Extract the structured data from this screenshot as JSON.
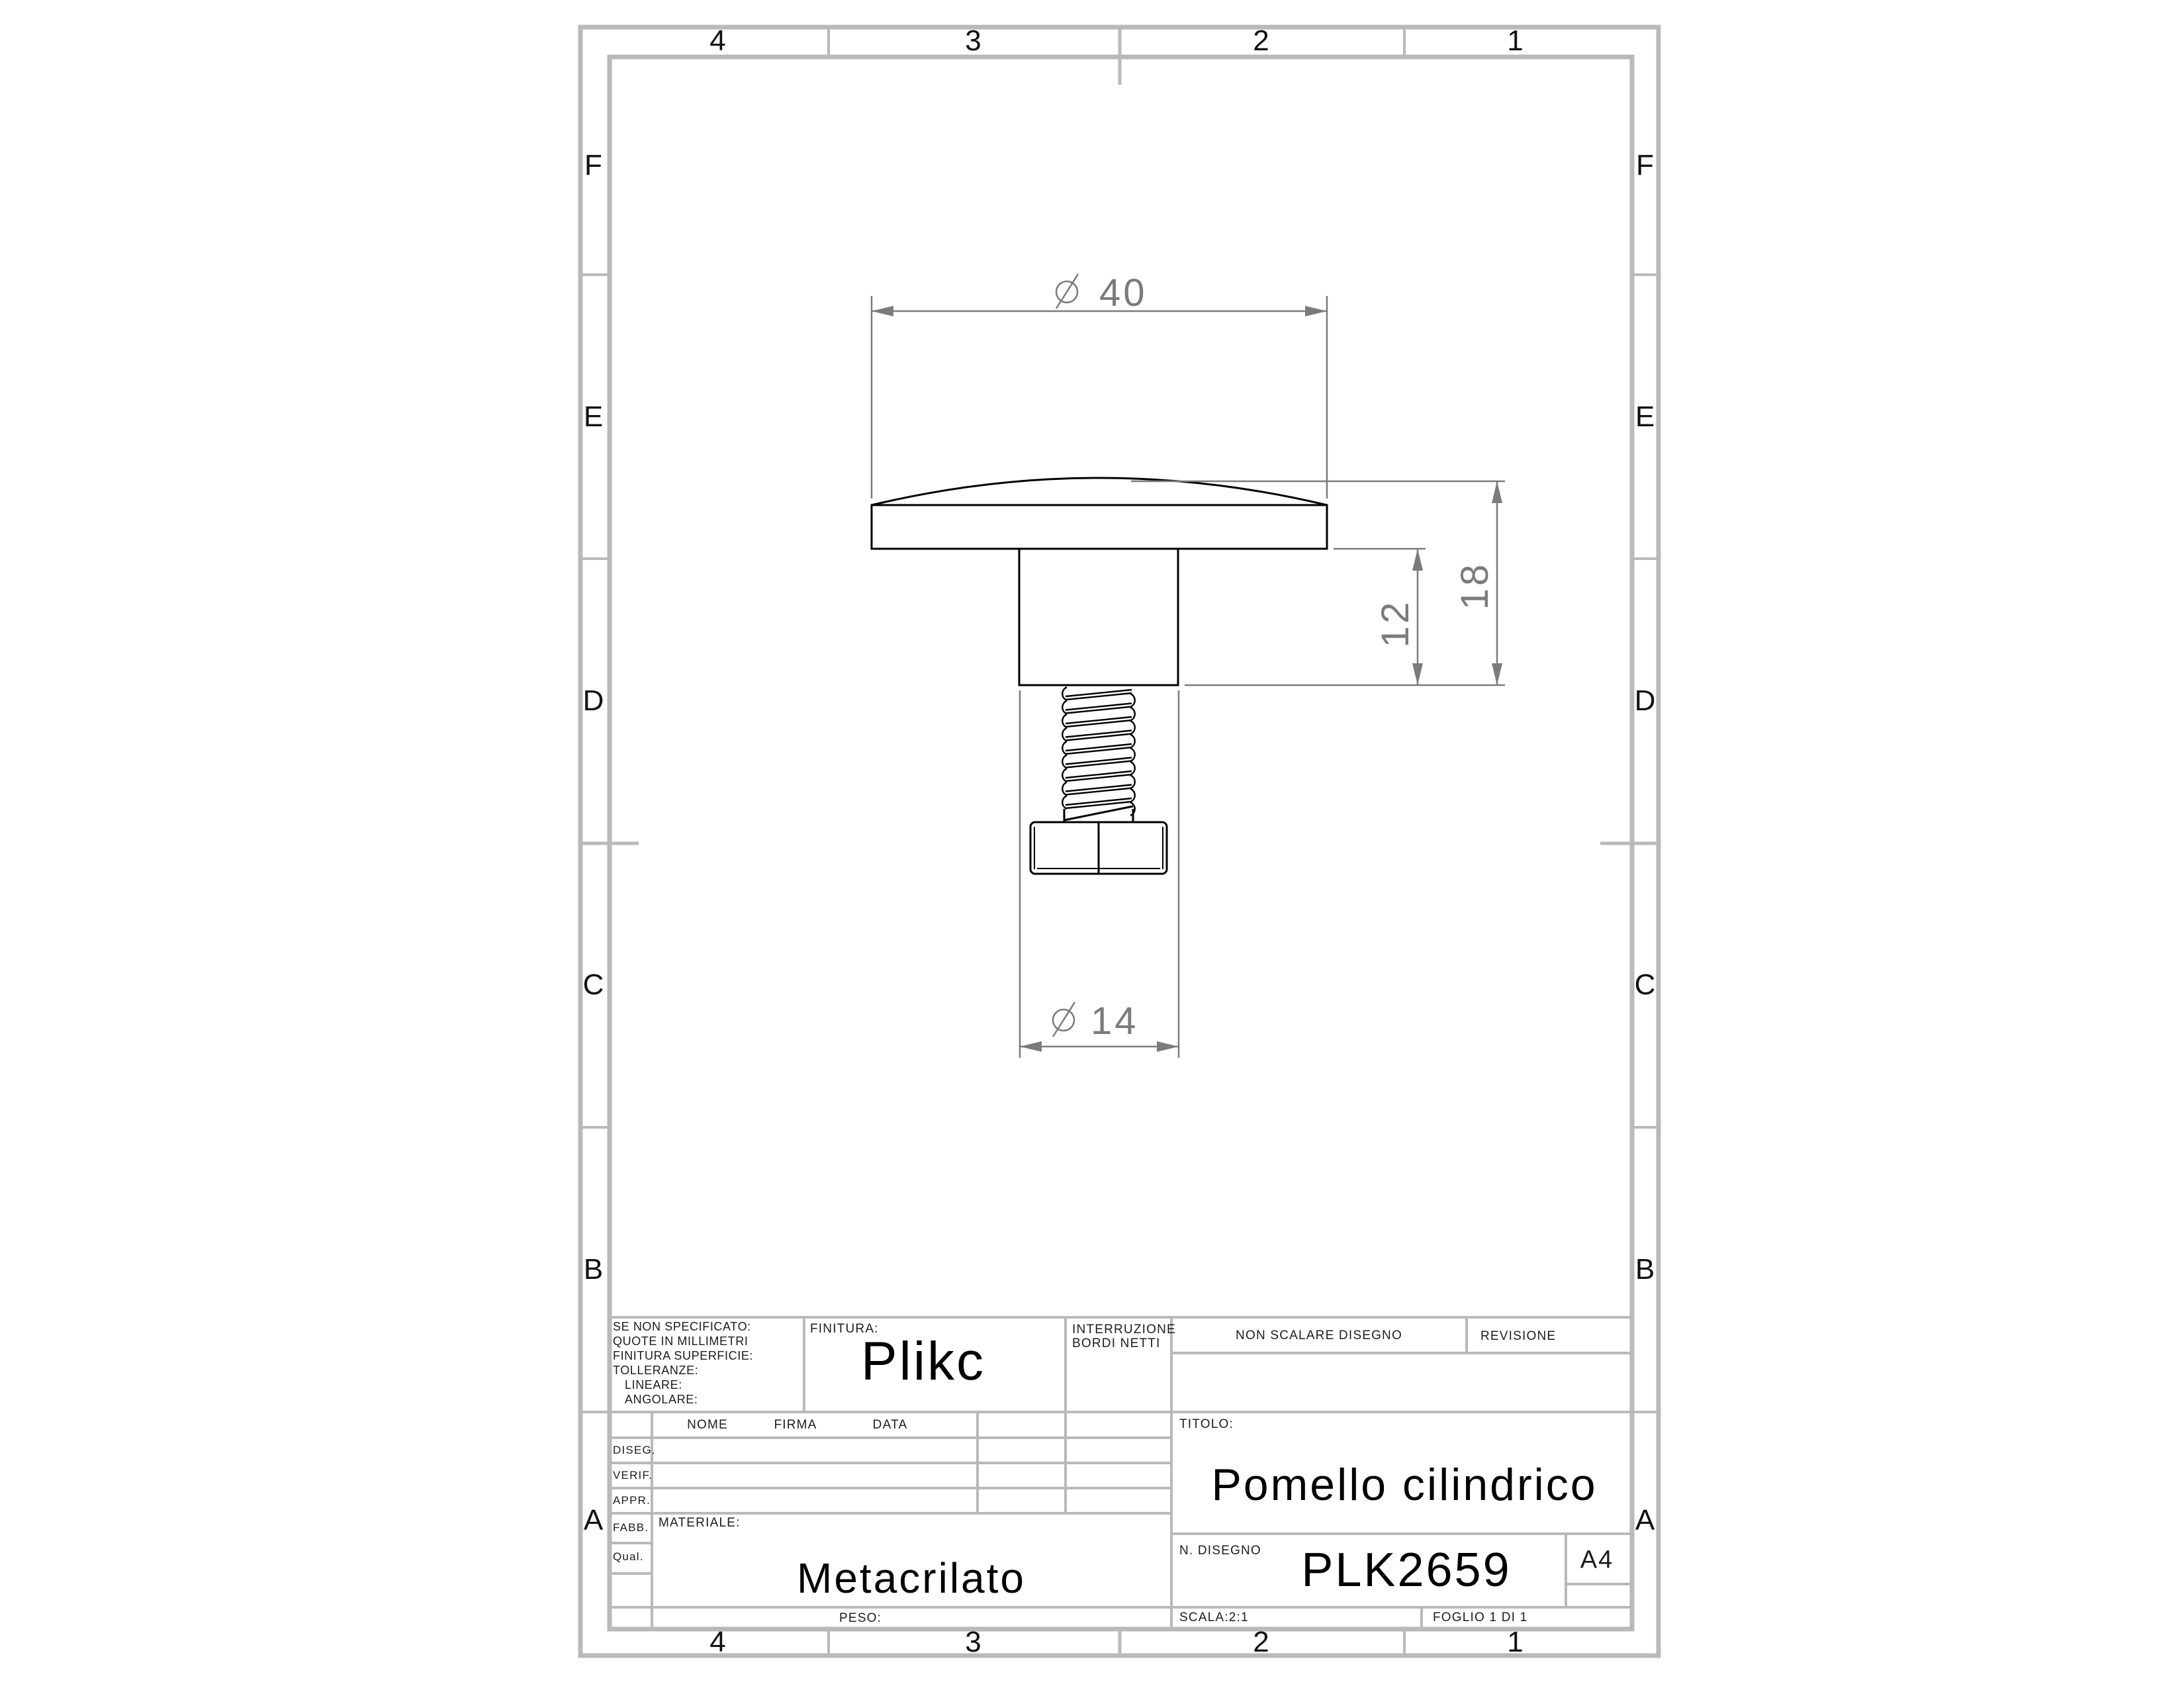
{
  "sheet": {
    "zones_h": [
      "4",
      "3",
      "2",
      "1"
    ],
    "zones_v": [
      "F",
      "E",
      "D",
      "C",
      "B",
      "A"
    ],
    "frame_color": "#b9b9b9",
    "dim_color": "#7b7b7b",
    "part_line_color": "#000000"
  },
  "title_block": {
    "tolerance_note": [
      "SE NON SPECIFICATO:",
      "QUOTE IN MILLIMETRI",
      "FINITURA SUPERFICIE:",
      "TOLLERANZE:",
      "LINEARE:",
      "ANGOLARE:"
    ],
    "finitura_label": "FINITURA:",
    "company": "Plikc",
    "interruzione_line1": "INTERRUZIONE",
    "interruzione_line2": "BORDI NETTI",
    "non_scalare": "NON SCALARE DISEGNO",
    "revisione_label": "REVISIONE",
    "col_headers": [
      "NOME",
      "FIRMA",
      "DATA"
    ],
    "row_labels": [
      "DISEG.",
      "VERIF.",
      "APPR.",
      "FABB.",
      "Qual."
    ],
    "materiale_label": "MATERIALE:",
    "materiale_value": "Metacrilato",
    "peso_label": "PESO:",
    "titolo_label": "TITOLO:",
    "titolo_value": "Pomello cilindrico",
    "n_disegno_label": "N. DISEGNO",
    "n_disegno_value": "PLK2659",
    "sheet_format": "A4",
    "scala": "SCALA:2:1",
    "foglio": "FOGLIO 1 DI 1"
  },
  "dimensions": {
    "d40": {
      "symbol": "Ø",
      "value": "40"
    },
    "d14": {
      "symbol": "Ø",
      "value": "14"
    },
    "d12": {
      "value": "12"
    },
    "d18": {
      "value": "18"
    }
  }
}
